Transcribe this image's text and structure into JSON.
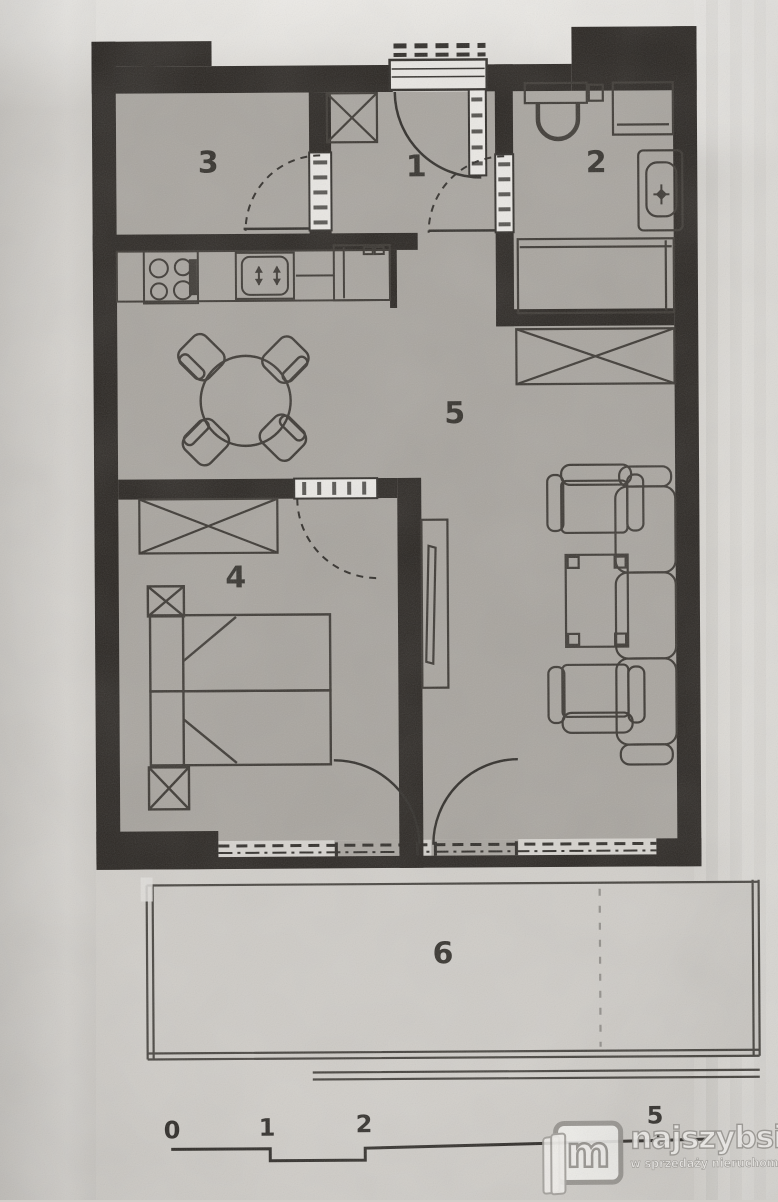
{
  "plan": {
    "rooms": [
      {
        "label": "3"
      },
      {
        "label": "1"
      },
      {
        "label": "2"
      },
      {
        "label": "5"
      },
      {
        "label": "4"
      },
      {
        "label": "6"
      }
    ],
    "scale_bar": {
      "labels": [
        "0",
        "1",
        "2",
        "5"
      ]
    },
    "colors": {
      "paper": "#d2cfca",
      "floor": "#a8a49e",
      "wall": "#282420",
      "furniture_line": "#3a3631",
      "door_leaf": "#eceae6"
    },
    "icons": {
      "furniture": [
        "stove-icon",
        "kitchen-sink-icon",
        "fridge-icon",
        "dining-table-icon",
        "dining-chair-icon",
        "toilet-icon",
        "washing-machine-icon",
        "washbasin-icon",
        "shower-icon",
        "wardrobe-icon",
        "bed-icon",
        "nightstand-icon",
        "tv-cabinet-icon",
        "armchair-icon",
        "coffee-table-icon",
        "sofa-icon",
        "door-leaf-icon",
        "door-swing-arc-icon",
        "window-band-icon",
        "entrance-steps-icon"
      ]
    }
  },
  "watermark": {
    "monogram": "m",
    "brand": "najszybsi",
    "tagline": "w sprzedaży nieruchomości"
  }
}
